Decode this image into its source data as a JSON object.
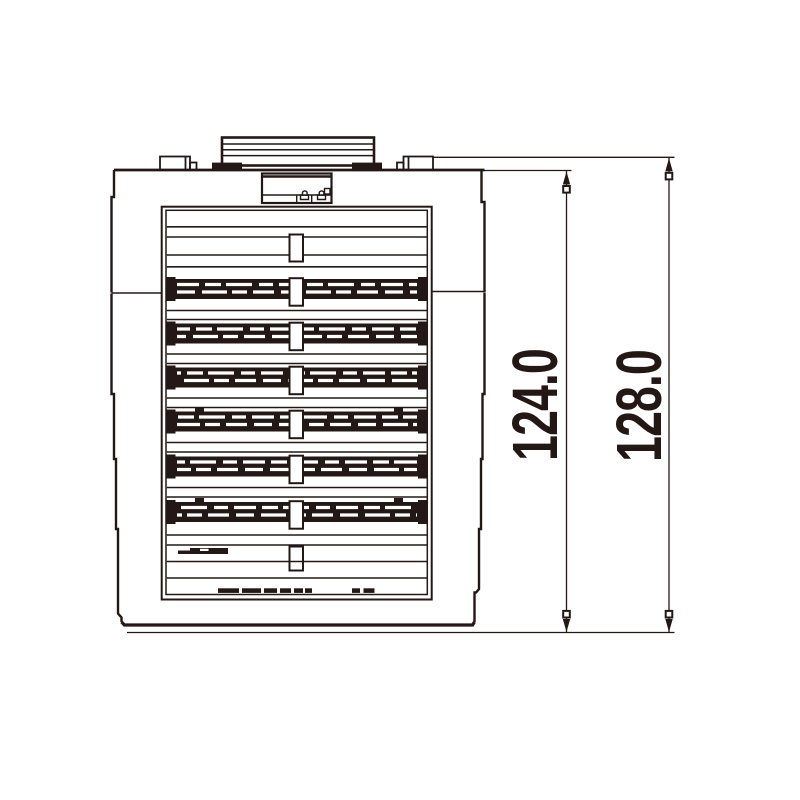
{
  "page": {
    "background_color": "#ffffff",
    "line_color": "#231815"
  },
  "drawing": {
    "kind": "mechanical-front-elevation",
    "description": "Front view of a finned/louvered device enclosure with top terminal cover and two vertical height dimensions",
    "vent_band_count": 6,
    "dimensions": [
      {
        "name": "body-height",
        "value": "124.0",
        "unit": "mm",
        "orientation": "vertical"
      },
      {
        "name": "overall-height",
        "value": "128.0",
        "unit": "mm",
        "orientation": "vertical"
      }
    ]
  }
}
